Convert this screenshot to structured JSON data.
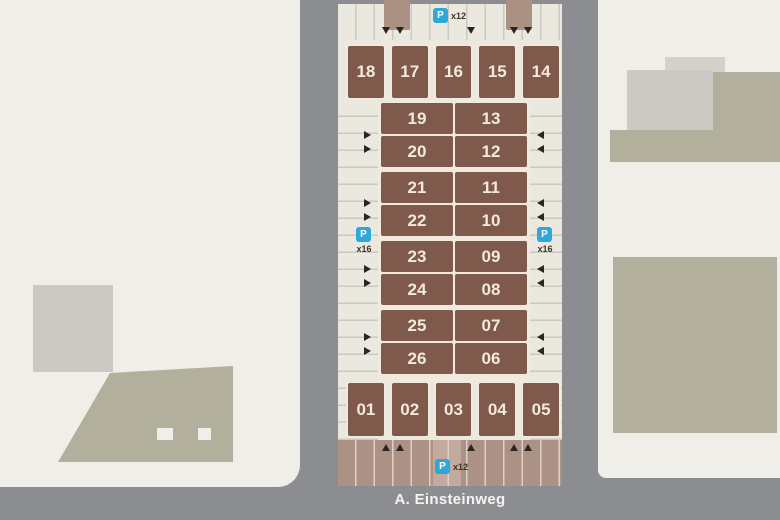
{
  "map": {
    "street_label": "A. Einsteinweg",
    "parking_badges": {
      "top": {
        "label": "P",
        "count": "x12"
      },
      "left": {
        "label": "P",
        "count": "x16"
      },
      "right": {
        "label": "P",
        "count": "x16"
      },
      "bottom": {
        "label": "P",
        "count": "x12"
      }
    },
    "plots": {
      "top_row": [
        "18",
        "17",
        "16",
        "15",
        "14"
      ],
      "inner_left_column": [
        "19",
        "20",
        "21",
        "22",
        "23",
        "24",
        "25",
        "26"
      ],
      "inner_right_column": [
        "13",
        "12",
        "11",
        "10",
        "09",
        "08",
        "07",
        "06"
      ],
      "bottom_row": [
        "01",
        "02",
        "03",
        "04",
        "05"
      ]
    },
    "icons": {
      "parking": "P-square",
      "entry_top": "arrow-down",
      "entry_bottom": "arrow-up",
      "aisle_left": "arrow-right",
      "aisle_right": "arrow-left"
    },
    "colors": {
      "road_gray": "#8b8d91",
      "block_white": "#efeee9",
      "building_gray": "#cbc9c3",
      "building_light": "#d4d1cb",
      "building_khaki": "#b2af9d",
      "map_cream": "#ebe8e0",
      "strip_line": "#ccc9c0",
      "plot_brown": "#7e594c",
      "plot_border": "#f0e9de",
      "plot_text": "#f3ead9",
      "bottom_tan": "#ac9185",
      "bottom_line": "#ddd0c4",
      "entry_brown": "#ab9084",
      "entry_light": "#c4aa9e",
      "parking_blue": "#2ea7db",
      "count_text": "#41332b",
      "arrow_dark": "#2b2420",
      "street_text": "#f6f5f1"
    }
  }
}
